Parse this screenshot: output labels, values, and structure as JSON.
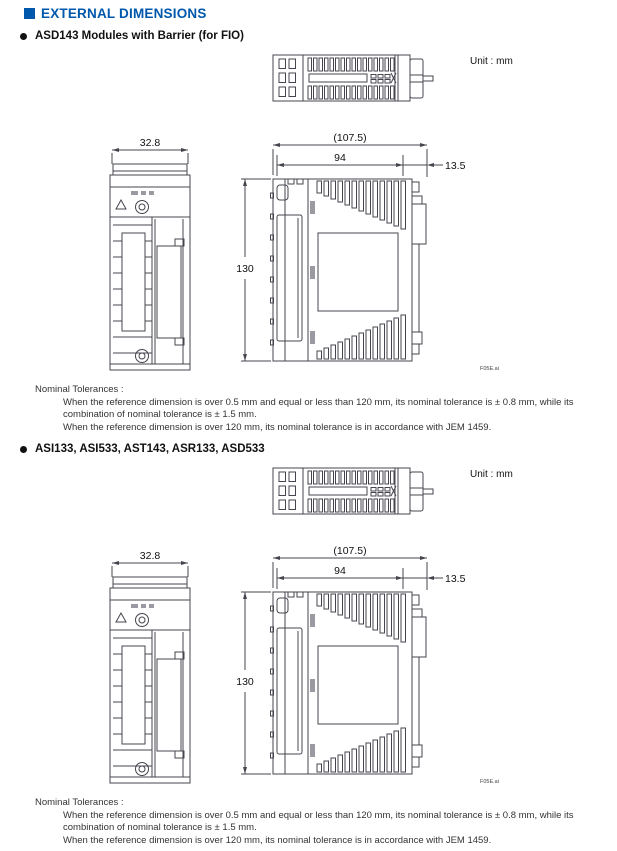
{
  "header": {
    "title": "EXTERNAL DIMENSIONS"
  },
  "sections": [
    {
      "heading": "ASD143 Modules with Barrier (for FIO)"
    },
    {
      "heading": "ASI133, ASI533, AST143, ASR133, ASD533"
    }
  ],
  "drawing": {
    "unit_label": "Unit : mm",
    "file_label": "F05E.ai",
    "dimensions": {
      "front_width_mm": "32.8",
      "overall_depth_mm": "(107.5)",
      "body_depth_mm": "94",
      "din_rail_depth_mm": "13.5",
      "height_mm": "130"
    }
  },
  "tolerances": {
    "title": "Nominal Tolerances :",
    "lines": [
      "When the reference dimension is over 0.5 mm and equal or less than 120 mm, its nominal tolerance is ± 0.8 mm, while its",
      "combination of nominal tolerance is ± 1.5 mm.",
      "When the reference dimension is over 120 mm, its nominal tolerance is in accordance with JEM 1459."
    ]
  },
  "colors": {
    "accent": "#0058AC",
    "line": "#45454f"
  }
}
